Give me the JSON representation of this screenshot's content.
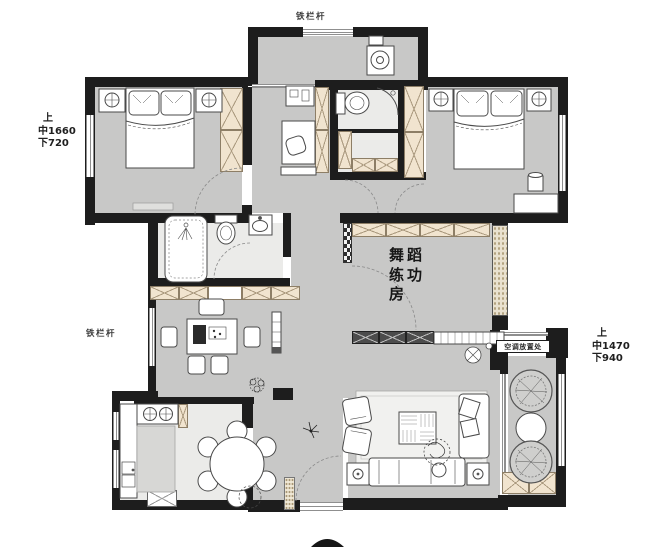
{
  "floorplan": {
    "name": "apartment-floor-plan",
    "rooms": {
      "dance_room": {
        "l1": "舞蹈",
        "l2": "练功",
        "l3": "房"
      }
    },
    "annotations": {
      "railing_top": "铁栏杆",
      "railing_left": "铁栏杆",
      "ac_label": "空调放置处",
      "dims_left": {
        "l1": "上",
        "l2": "中1660",
        "l3": "下720"
      },
      "dims_right": {
        "l1": "上",
        "l2": "中1470",
        "l3": "下940"
      }
    },
    "colors": {
      "wall": "#1d1d1d",
      "floor": "#c8c8c7",
      "floor_light": "#ebebe9",
      "cabinet_fill": "#f1e4cf",
      "stone_fill": "#e9e1cf"
    }
  }
}
